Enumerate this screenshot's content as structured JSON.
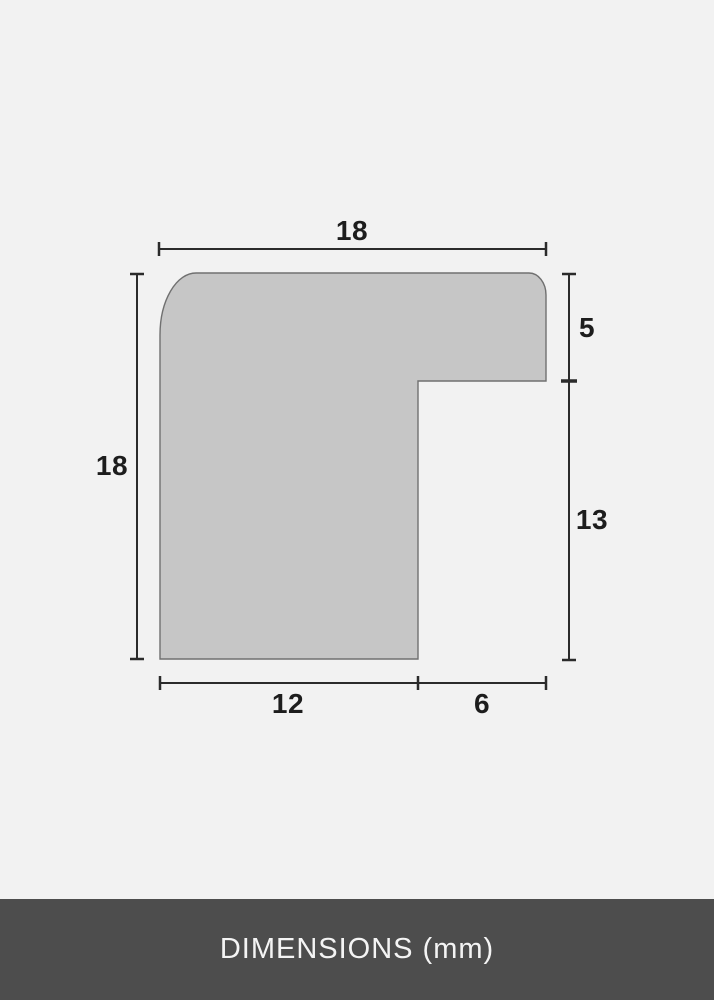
{
  "diagram": {
    "type": "frame-profile-cross-section",
    "labels": {
      "top_width": "18",
      "left_height": "18",
      "right_upper_height": "5",
      "right_lower_height": "13",
      "bottom_left_width": "12",
      "bottom_right_width": "6"
    }
  },
  "footer": {
    "title": "DIMENSIONS (mm)"
  },
  "colors": {
    "background": "#f2f2f2",
    "shape_fill": "#c6c6c6",
    "shape_stroke": "#707070",
    "dimension_line": "#2b2b2b",
    "label_text": "#1d1d1d",
    "footer_background": "#4d4d4d",
    "footer_text": "#f4f4f4"
  }
}
